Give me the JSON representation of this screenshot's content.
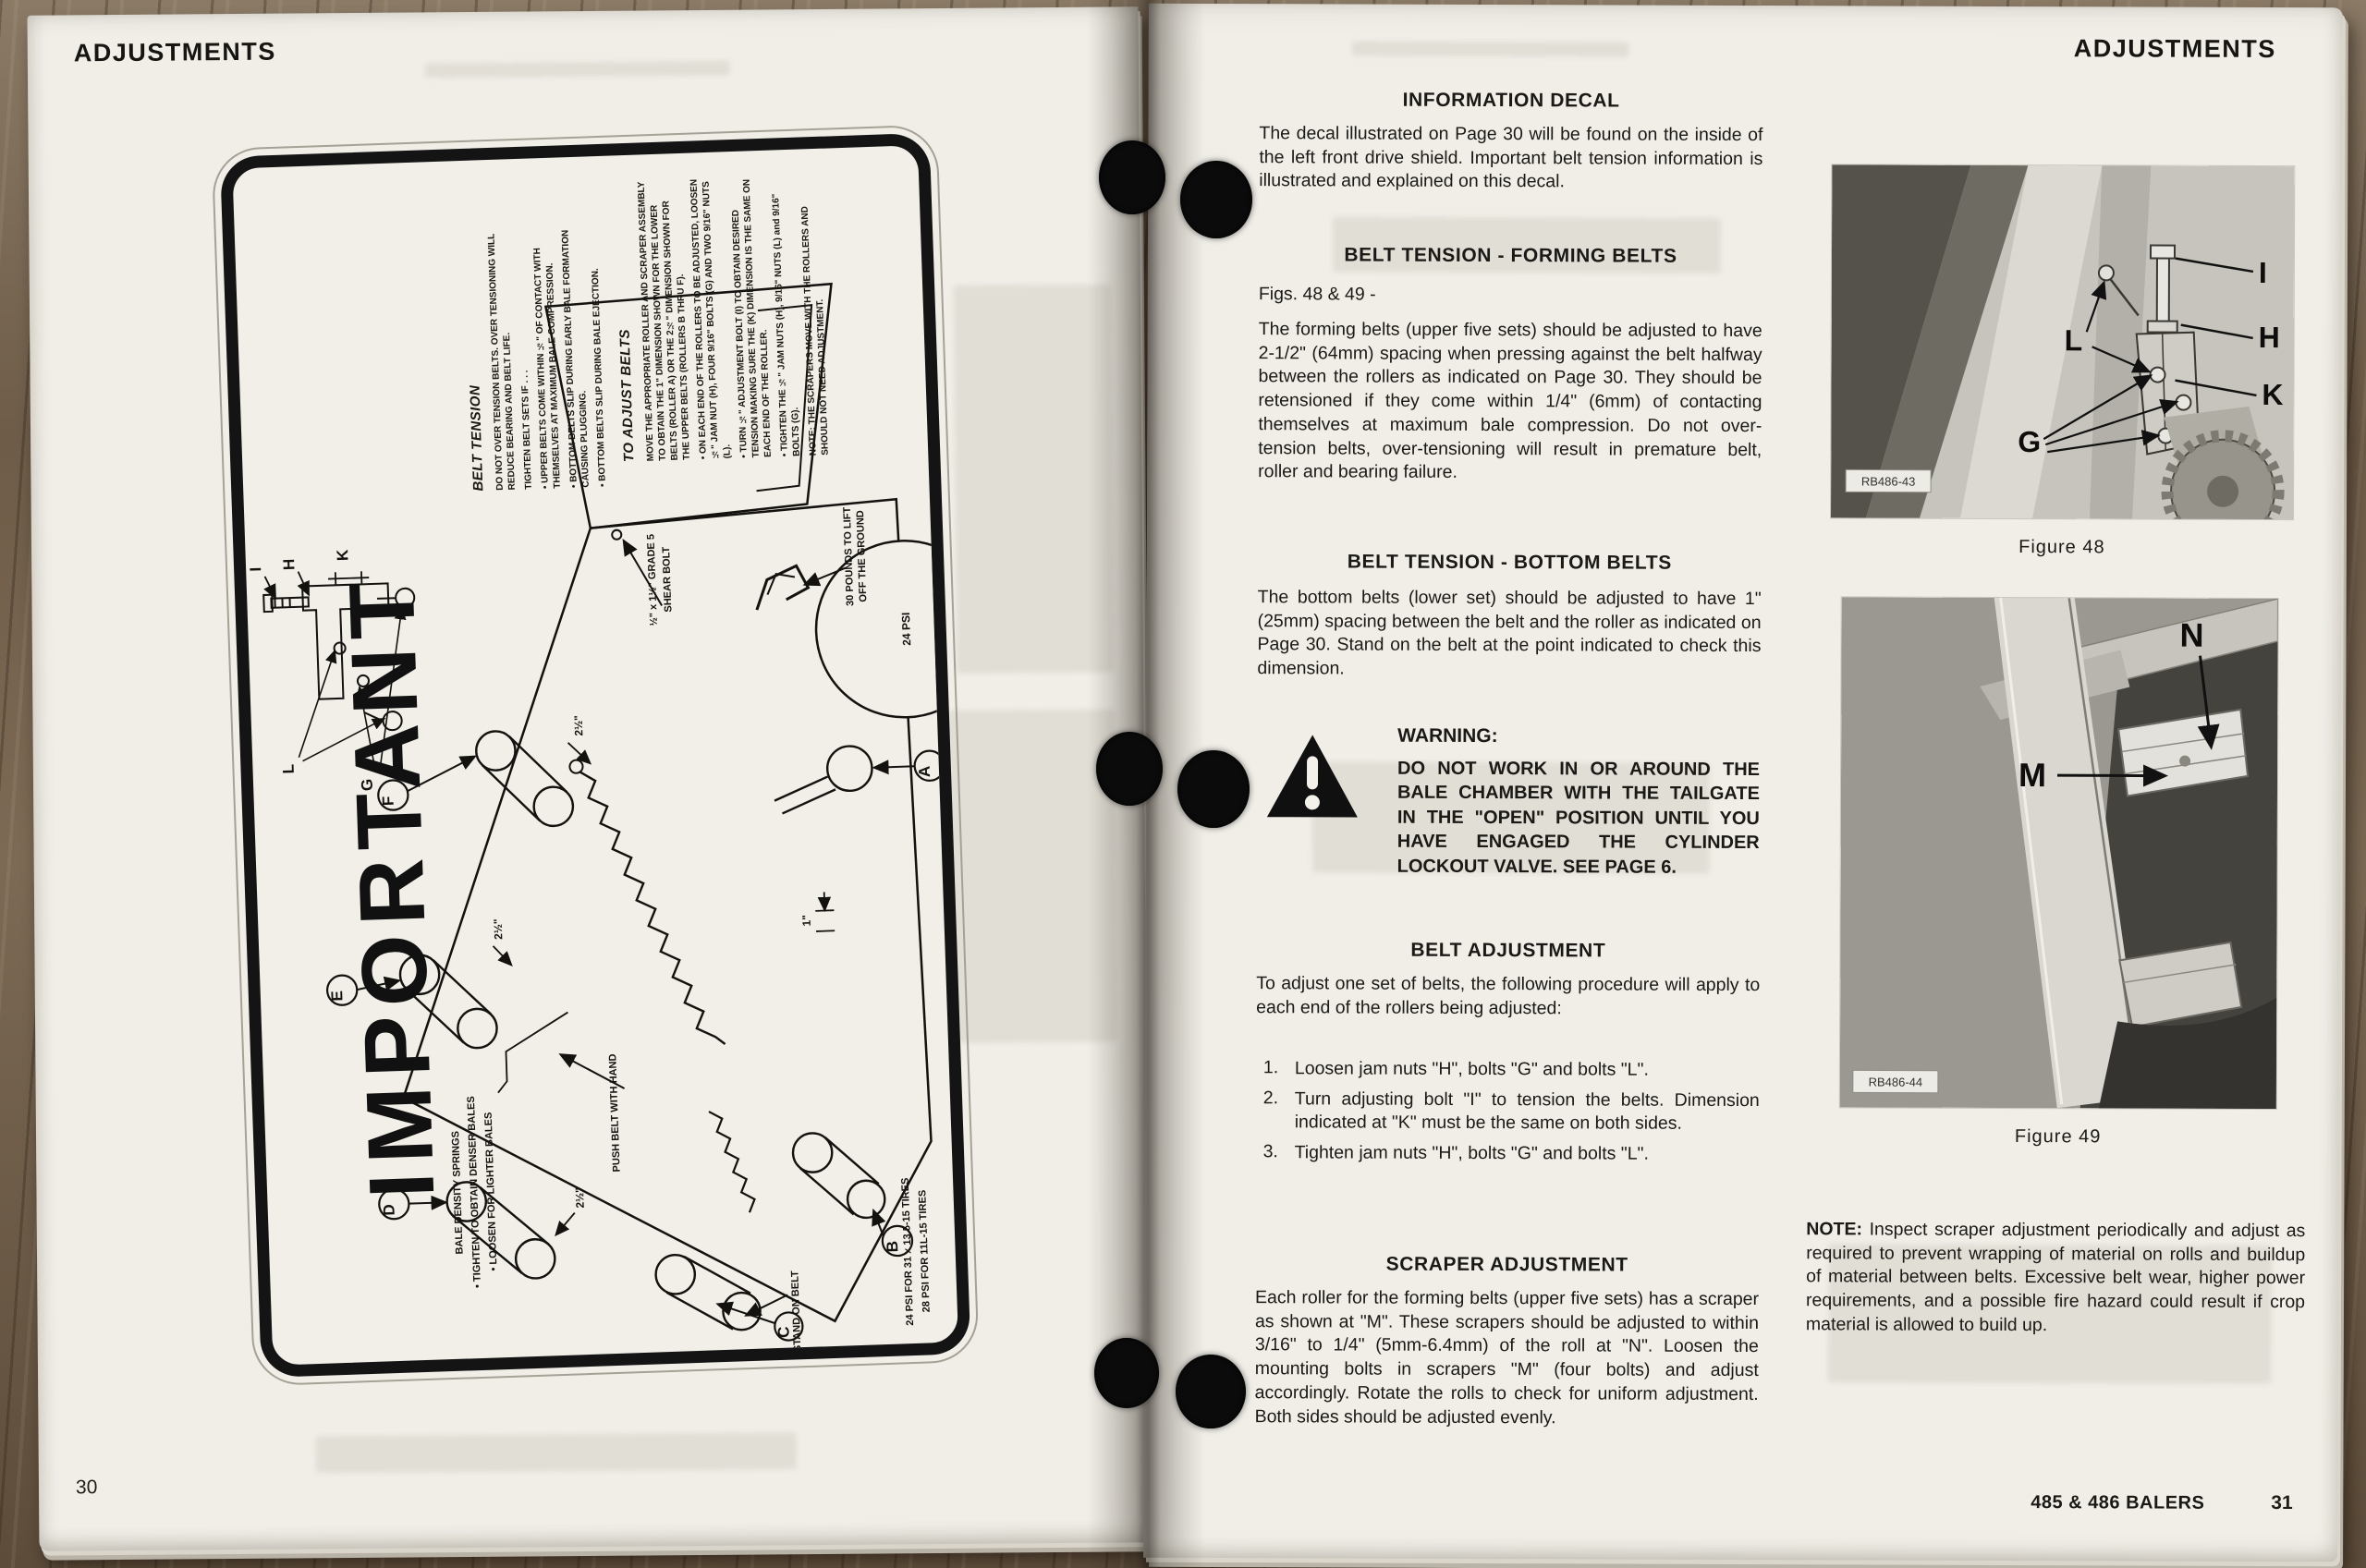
{
  "page30": {
    "header": "ADJUSTMENTS",
    "page_number": "30"
  },
  "decal": {
    "title": "IMPORTANT",
    "belt_tension": {
      "heading": "BELT TENSION",
      "para1": "DO NOT OVER TENSION BELTS. OVER TENSIONING WILL REDUCE BEARING AND BELT LIFE.",
      "para2": "TIGHTEN BELT SETS IF . . .",
      "bullets": [
        "UPPER BELTS COME WITHIN ½\" OF CONTACT WITH THEMSELVES AT MAXIMUM BALE COMPRESSION.",
        "BOTTOM BELTS SLIP DURING EARLY BALE FORMATION CAUSING PLUGGING.",
        "BOTTOM BELTS SLIP DURING BALE EJECTION."
      ]
    },
    "to_adjust": {
      "heading": "TO ADJUST BELTS",
      "para1": "MOVE THE APPROPRIATE ROLLER AND SCRAPER ASSEMBLY TO OBTAIN THE 1\" DIMENSION SHOWN FOR THE LOWER BELTS (ROLLER A) OR THE 2½\" DIMENSION SHOWN FOR THE UPPER BELTS (ROLLERS B THRU F).",
      "bullets": [
        "ON EACH END OF THE ROLLERS TO BE ADJUSTED, LOOSEN ½\" JAM NUT (H), FOUR 9/16\" BOLTS (G) AND TWO 9/16\" NUTS (L).",
        "TURN ½\" ADJUSTMENT BOLT (I) TO OBTAIN DESIRED TENSION MAKING SURE THE (K) DIMENSION IS THE SAME ON EACH END OF THE ROLLER.",
        "TIGHTEN THE ½\" JAM NUTS (H), 9/16\" NUTS (L) and 9/16\" BOLTS (G)."
      ],
      "note": "NOTE: THE SCRAPERS MOVE WITH THE ROLLERS AND SHOULD NOT NEED ADJUSTMENT."
    },
    "diagram": {
      "circle_labels": [
        "A",
        "B",
        "C",
        "D",
        "E",
        "F"
      ],
      "detail_labels": [
        "I",
        "H",
        "K",
        "L",
        "G"
      ],
      "shear_bolt_line1": "½\" x 1½\" GRADE 5",
      "shear_bolt_line2": "SHEAR BOLT",
      "lift_line1": "30 POUNDS TO LIFT",
      "lift_line2": "OFF THE GROUND",
      "tire_psi": "24 PSI",
      "density_line1": "BALE DENSITY SPRINGS",
      "density_line2": "• TIGHTEN TO OBTAIN DENSER BALES",
      "density_line3": "• LOOSEN FOR LIGHTER BALES",
      "push_label": "PUSH BELT WITH HAND",
      "stand_label": "STAND ON BELT",
      "psi_line1": "24 PSI FOR 31 x 13.5-15 TIRES",
      "psi_line2": "28 PSI FOR 11L-15 TIRES",
      "dim_upper": "2½\"",
      "dim_lower": "1\""
    }
  },
  "page31": {
    "header": "ADJUSTMENTS",
    "info": {
      "heading": "INFORMATION DECAL",
      "body": "The decal illustrated on Page 30 will be found on the inside of the left front drive shield. Important belt tension information is illustrated and explained on this decal."
    },
    "forming": {
      "heading": "BELT TENSION - FORMING BELTS",
      "figs": "Figs. 48 & 49 -",
      "body": "The forming belts (upper five sets) should be adjusted to have 2-1/2\" (64mm) spacing when pressing against the belt halfway between the rollers as indicated on Page 30. They should be retensioned if they come within 1/4\" (6mm) of contacting themselves at maximum bale compression. Do not over-tension belts, over-tensioning will result in premature belt, roller and bearing failure."
    },
    "bottom": {
      "heading": "BELT TENSION - BOTTOM BELTS",
      "body": "The bottom belts (lower set) should be adjusted to have 1\" (25mm) spacing between the belt and the roller as indicated on Page 30. Stand on the belt at the point indicated to check this dimension."
    },
    "warning": {
      "label": "WARNING:",
      "body": "DO NOT WORK IN OR AROUND THE BALE CHAMBER WITH THE TAILGATE IN THE \"OPEN\" POSITION UNTIL YOU HAVE ENGAGED THE CYLINDER LOCKOUT VALVE. SEE PAGE 6."
    },
    "belt_adjustment": {
      "heading": "BELT ADJUSTMENT",
      "intro": "To adjust one set of belts, the following procedure will apply to each end of the rollers being adjusted:",
      "steps": [
        {
          "num": "1.",
          "text": "Loosen jam nuts \"H\", bolts \"G\" and bolts \"L\"."
        },
        {
          "num": "2.",
          "text": "Turn adjusting bolt \"I\" to tension the belts. Dimension indicated at \"K\" must be the same on both sides."
        },
        {
          "num": "3.",
          "text": "Tighten jam nuts \"H\", bolts \"G\" and bolts \"L\"."
        }
      ]
    },
    "scraper": {
      "heading": "SCRAPER ADJUSTMENT",
      "body": "Each roller for the forming belts (upper five sets) has a scraper as shown at \"M\". These scrapers should be adjusted to within 3/16\" to 1/4\" (5mm-6.4mm) of the roll at \"N\". Loosen the mounting bolts in scrapers \"M\" (four bolts) and adjust accordingly. Rotate the rolls to check for uniform adjustment. Both sides should be adjusted evenly."
    },
    "note": {
      "label": "NOTE:",
      "body": "Inspect scraper adjustment periodically and adjust as required to prevent wrapping of material on rolls and buildup of material between belts. Excessive belt wear, higher power requirements, and a possible fire hazard could result if crop material is allowed to build up."
    },
    "footer_title": "485 & 486 BALERS",
    "page_number": "31"
  },
  "figures": [
    {
      "caption": "Figure 48",
      "photo_id": "RB486-43",
      "labels": [
        "I",
        "H",
        "K",
        "L",
        "G"
      ]
    },
    {
      "caption": "Figure 49",
      "photo_id": "RB486-44",
      "labels": [
        "N",
        "M"
      ]
    }
  ]
}
